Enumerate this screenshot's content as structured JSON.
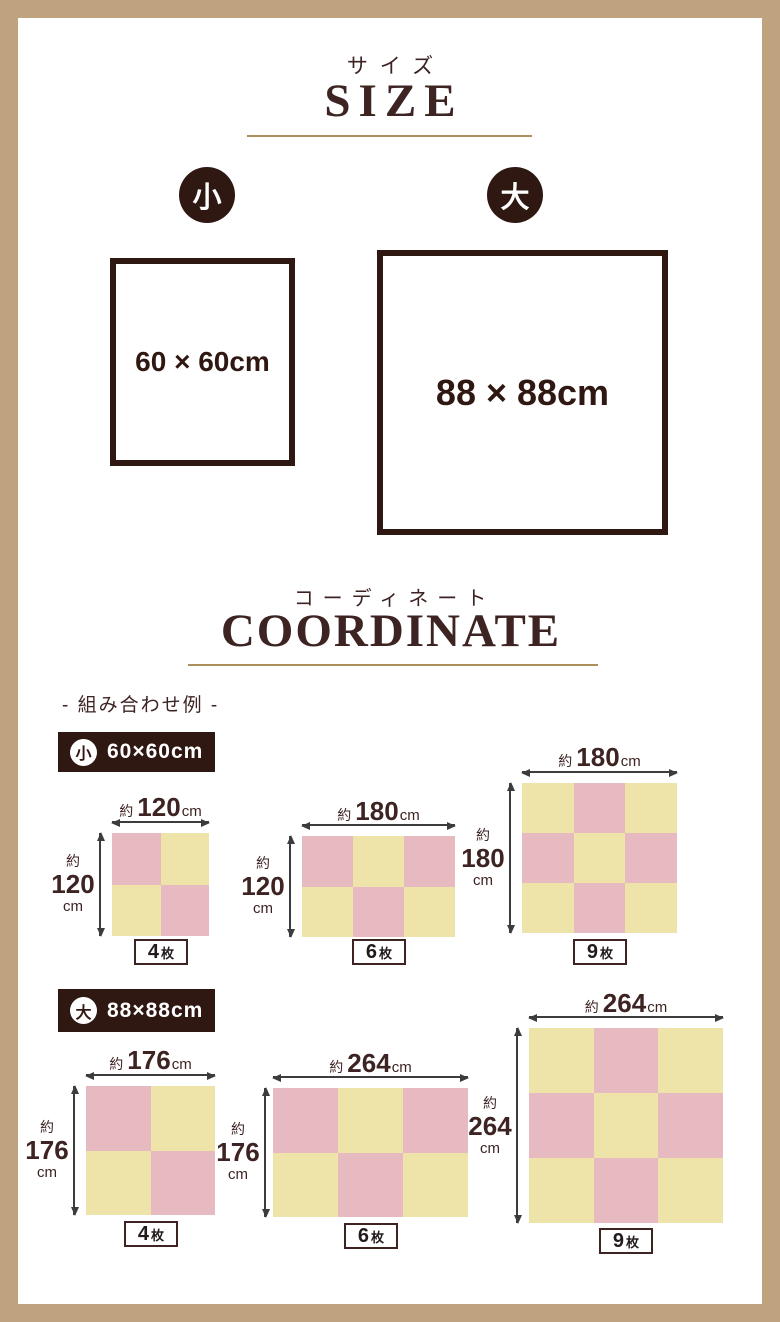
{
  "colors": {
    "frame": "#bfa37e",
    "dark": "#2f1712",
    "heading": "#3e2323",
    "gold": "#ab8f5c",
    "pink": "#e7bac2",
    "yellow": "#eee4a9",
    "arrow": "#3c3c3c",
    "count_text": "#231b1b"
  },
  "size_section": {
    "title_jp": "サイズ",
    "title_en": "SIZE",
    "small": {
      "badge": "小",
      "dimension": "60 × 60cm"
    },
    "large": {
      "badge": "大",
      "dimension": "88 × 88cm"
    }
  },
  "coordinate_section": {
    "title_jp": "コーディネート",
    "title_en": "COORDINATE",
    "subtitle": "- 組み合わせ例 -",
    "groups": [
      {
        "badge": "小",
        "size_label": "60×60cm",
        "layouts": [
          {
            "width": {
              "prefix": "約",
              "value": "120",
              "unit": "cm"
            },
            "height": {
              "prefix": "約",
              "value": "120",
              "unit": "cm"
            },
            "count": {
              "value": "4",
              "unit": "枚"
            },
            "grid": {
              "cols": 2,
              "rows": 2,
              "pattern": [
                "pink",
                "yellow",
                "yellow",
                "pink"
              ]
            }
          },
          {
            "width": {
              "prefix": "約",
              "value": "180",
              "unit": "cm"
            },
            "height": {
              "prefix": "約",
              "value": "120",
              "unit": "cm"
            },
            "count": {
              "value": "6",
              "unit": "枚"
            },
            "grid": {
              "cols": 3,
              "rows": 2,
              "pattern": [
                "pink",
                "yellow",
                "pink",
                "yellow",
                "pink",
                "yellow"
              ]
            }
          },
          {
            "width": {
              "prefix": "約",
              "value": "180",
              "unit": "cm"
            },
            "height": {
              "prefix": "約",
              "value": "180",
              "unit": "cm"
            },
            "count": {
              "value": "9",
              "unit": "枚"
            },
            "grid": {
              "cols": 3,
              "rows": 3,
              "pattern": [
                "yellow",
                "pink",
                "yellow",
                "pink",
                "yellow",
                "pink",
                "yellow",
                "pink",
                "yellow"
              ]
            }
          }
        ]
      },
      {
        "badge": "大",
        "size_label": "88×88cm",
        "layouts": [
          {
            "width": {
              "prefix": "約",
              "value": "176",
              "unit": "cm"
            },
            "height": {
              "prefix": "約",
              "value": "176",
              "unit": "cm"
            },
            "count": {
              "value": "4",
              "unit": "枚"
            },
            "grid": {
              "cols": 2,
              "rows": 2,
              "pattern": [
                "pink",
                "yellow",
                "yellow",
                "pink"
              ]
            }
          },
          {
            "width": {
              "prefix": "約",
              "value": "264",
              "unit": "cm"
            },
            "height": {
              "prefix": "約",
              "value": "176",
              "unit": "cm"
            },
            "count": {
              "value": "6",
              "unit": "枚"
            },
            "grid": {
              "cols": 3,
              "rows": 2,
              "pattern": [
                "pink",
                "yellow",
                "pink",
                "yellow",
                "pink",
                "yellow"
              ]
            }
          },
          {
            "width": {
              "prefix": "約",
              "value": "264",
              "unit": "cm"
            },
            "height": {
              "prefix": "約",
              "value": "264",
              "unit": "cm"
            },
            "count": {
              "value": "9",
              "unit": "枚"
            },
            "grid": {
              "cols": 3,
              "rows": 3,
              "pattern": [
                "yellow",
                "pink",
                "yellow",
                "pink",
                "yellow",
                "pink",
                "yellow",
                "pink",
                "yellow"
              ]
            }
          }
        ]
      }
    ]
  }
}
